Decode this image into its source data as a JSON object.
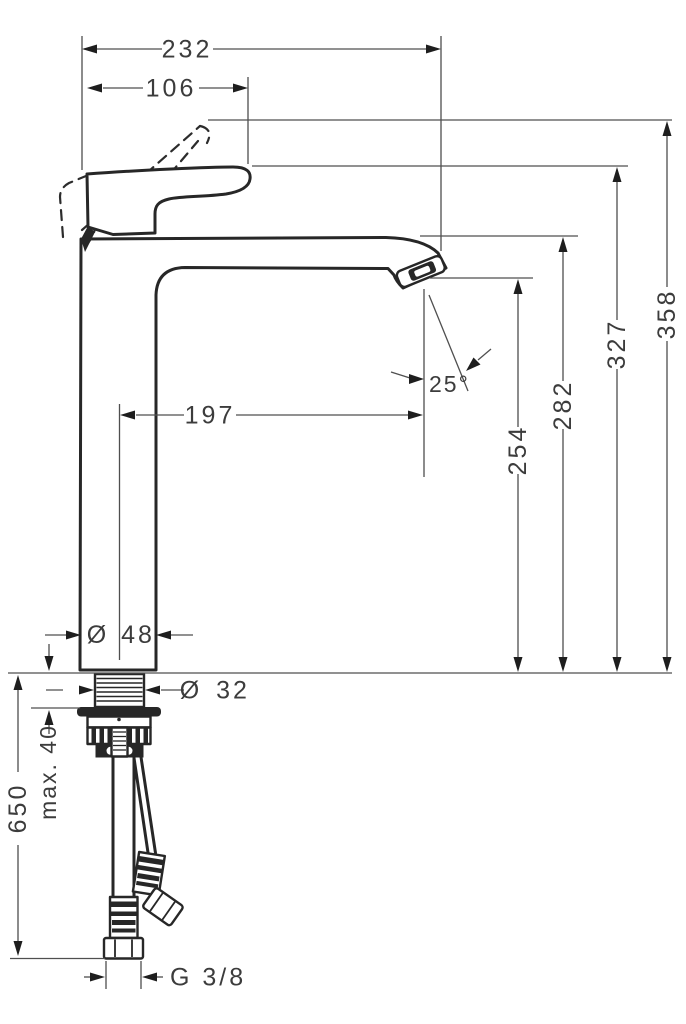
{
  "dimensions": {
    "total_width_mm": "232",
    "handle_width_mm": "106",
    "total_height_mm": "358",
    "handle_height_mm": "327",
    "spout_top_height_mm": "282",
    "outlet_height_mm": "254",
    "spout_reach_mm": "197",
    "stream_angle": "25°",
    "diameter_symbol": "Ø",
    "body_diameter_mm": "48",
    "shank_diameter_mm": "32",
    "max_mounting_thickness": "max. 40",
    "hose_length_mm": "650",
    "connection_thread": "G 3/8"
  },
  "colors": {
    "outline": "#272727",
    "dimension_line": "#4f4f4f",
    "text": "#3c3c3c",
    "background": "#ffffff"
  }
}
